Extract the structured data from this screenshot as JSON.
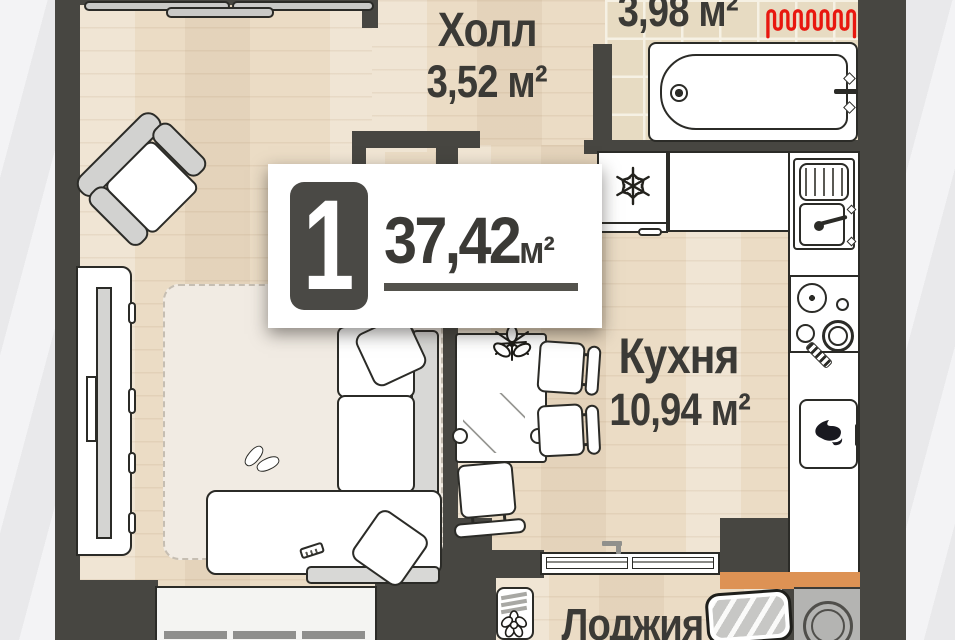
{
  "badge": {
    "rooms_count": "1",
    "area_value": "37,42",
    "area_unit": "м²"
  },
  "rooms": {
    "hall": {
      "name": "Холл",
      "area": "3,52 м²"
    },
    "bathroom": {
      "area": "3,98 м²"
    },
    "kitchen": {
      "name": "Кухня",
      "area": "10,94 м²"
    },
    "loggia": {
      "name": "Лоджия"
    }
  },
  "colors": {
    "wall": "#474641",
    "radiator_accent": "#e8170f",
    "loggia_accent": "#dd9254",
    "badge_number_bg": "#4a4945",
    "label_text": "#3b3a36"
  }
}
